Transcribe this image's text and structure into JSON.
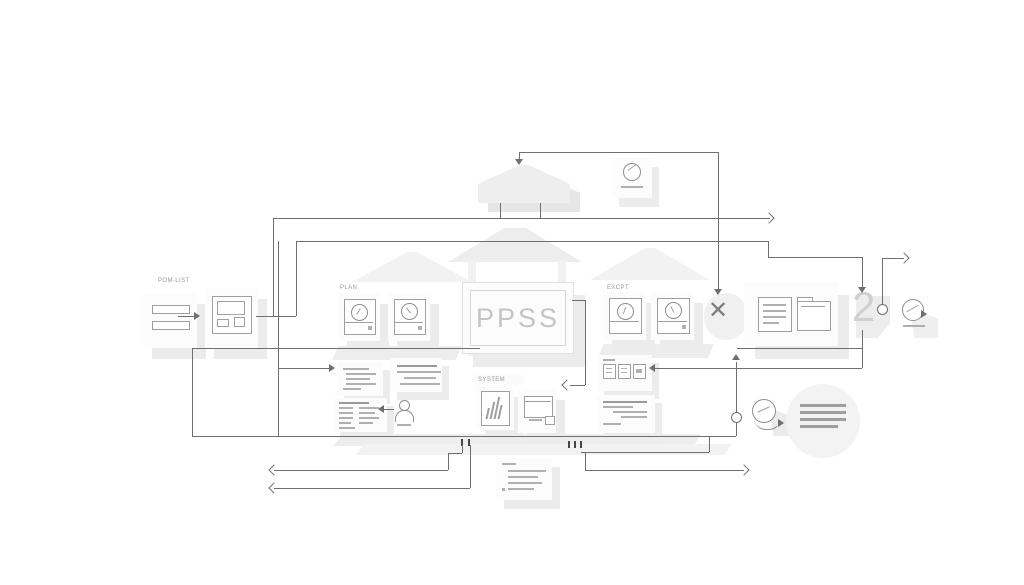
{
  "diagram": {
    "sign": {
      "title": "PPSS"
    },
    "groups": {
      "pom": {
        "label": "POM-LIST"
      },
      "plan": {
        "label": "PLAN"
      },
      "excpt": {
        "label": "EXCPT"
      },
      "system": {
        "label": "SYSTEM"
      }
    },
    "nodes": {
      "count_badge": "2",
      "reject_mark": "✕"
    },
    "colors": {
      "background": "#ffffff",
      "connector": "#6f6f6f",
      "card": "#fcfcfc",
      "card_shadow": "#ececec",
      "icon_stroke": "#8d8d8d",
      "sign_text": "#c4c4c4",
      "muted_label": "#9b9b9b"
    }
  }
}
